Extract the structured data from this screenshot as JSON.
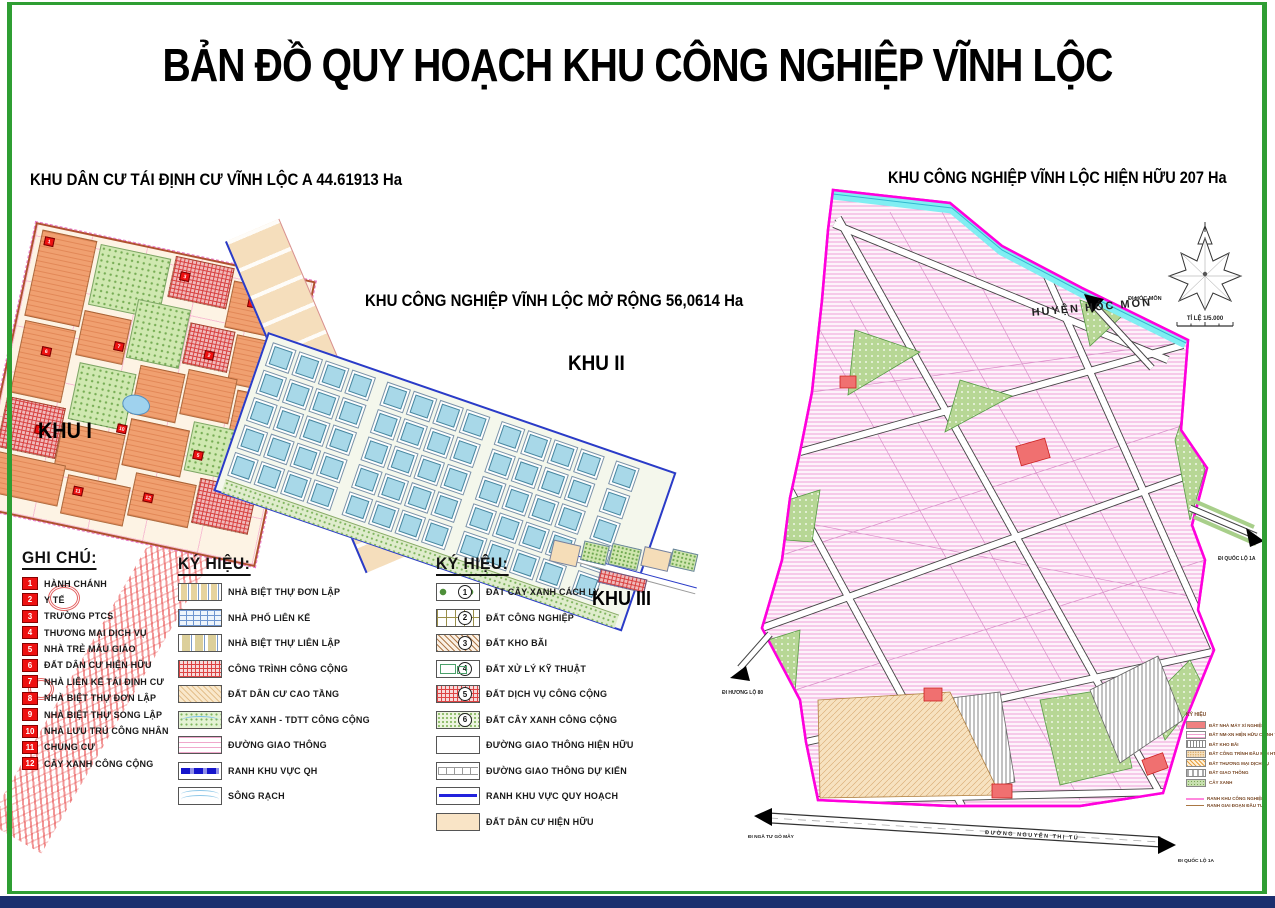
{
  "title": "BẢN ĐỒ QUY HOẠCH KHU CÔNG NGHIỆP VĨNH LỘC",
  "headers": {
    "residential": "KHU DÂN CƯ TÁI ĐỊNH CƯ VĨNH LỘC A 44.61913 Ha",
    "expansion": "KHU CÔNG NGHIỆP VĨNH LỘC MỞ RỘNG 56,0614 Ha",
    "existing": "KHU CÔNG NGHIỆP VĨNH LỘC HIỆN HỮU 207 Ha"
  },
  "zones": {
    "zone1": "KHU I",
    "zone2": "KHU II",
    "zone3": "KHU III"
  },
  "map_labels": {
    "district": "HUYỆN HÓC MÔN",
    "scale": "TỈ LỆ 1/5.000",
    "bottom_road": "ĐƯỜNG NGUYỄN THỊ TÚ",
    "arrow_nw": "ĐI HÓC MÔN",
    "arrow_right": "ĐI QUỐC LỘ 1A",
    "arrow_sw": "ĐI HƯƠNG LỘ 80",
    "arrow_bottom_left": "ĐI NGÃ TƯ GÒ MÂY",
    "arrow_bottom_right": "ĐI QUỐC LỘ 1A"
  },
  "legend_notes": {
    "title": "GHI CHÚ:",
    "items": [
      {
        "num": "1",
        "label": "HÀNH CHÁNH"
      },
      {
        "num": "2",
        "label": "Y TẾ"
      },
      {
        "num": "3",
        "label": "TRƯỜNG PTCS"
      },
      {
        "num": "4",
        "label": "THƯƠNG MẠI DỊCH VỤ"
      },
      {
        "num": "5",
        "label": "NHÀ TRẺ MẪU GIÁO"
      },
      {
        "num": "6",
        "label": "ĐẤT DÂN CƯ HIỆN HỮU"
      },
      {
        "num": "7",
        "label": "NHÀ LIÊN KẾ TÁI ĐỊNH CƯ"
      },
      {
        "num": "8",
        "label": "NHÀ BIỆT THỰ ĐƠN LẬP"
      },
      {
        "num": "9",
        "label": "NHÀ BIỆT THỰ SONG LẬP"
      },
      {
        "num": "10",
        "label": "NHÀ LƯU TRÚ CÔNG NHÂN"
      },
      {
        "num": "11",
        "label": "CHUNG CƯ"
      },
      {
        "num": "12",
        "label": "CÂY XANH CÔNG CỘNG"
      }
    ]
  },
  "legend_symbols1": {
    "title": "KÝ HIỆU:",
    "items": [
      {
        "label": "NHÀ BIỆT THỰ ĐƠN LẬP",
        "swatch": "sw-villa"
      },
      {
        "label": "NHÀ PHỐ LIÊN KẾ",
        "swatch": "sw-rowhouse"
      },
      {
        "label": "NHÀ BIỆT THỰ LIÊN LẬP",
        "swatch": "sw-duplex"
      },
      {
        "label": "CÔNG TRÌNH CÔNG CỘNG",
        "swatch": "sw-public"
      },
      {
        "label": "ĐẤT DÂN CƯ CAO TẦNG",
        "swatch": "sw-hirise"
      },
      {
        "label": "CÂY XANH - TDTT CÔNG CỘNG",
        "swatch": "sw-greentdtt"
      },
      {
        "label": "ĐƯỜNG GIAO THÔNG",
        "swatch": "sw-road"
      },
      {
        "label": "RANH KHU VỰC QH",
        "swatch": "sw-ranh"
      },
      {
        "label": "SÔNG RẠCH",
        "swatch": "sw-river"
      }
    ]
  },
  "legend_symbols2": {
    "title": "KÝ HIỆU:",
    "items": [
      {
        "num": "1",
        "label": "ĐẤT CÂY XANH CÁCH LY",
        "swatch": "sw-isogreen"
      },
      {
        "num": "2",
        "label": "ĐẤT CÔNG NGHIỆP",
        "swatch": "sw-industry"
      },
      {
        "num": "3",
        "label": "ĐẤT KHO BÃI",
        "swatch": "sw-khobai"
      },
      {
        "num": "4",
        "label": "ĐẤT XỬ LÝ KỸ THUẬT",
        "swatch": "sw-kythuat"
      },
      {
        "num": "5",
        "label": "ĐẤT DỊCH VỤ CÔNG CỘNG",
        "swatch": "sw-dichvu"
      },
      {
        "num": "6",
        "label": "ĐẤT CÂY XANH CÔNG CỘNG",
        "swatch": "sw-greenpark"
      },
      {
        "label": "ĐƯỜNG GIAO THÔNG HIỆN HỮU",
        "swatch": "sw-roadexist"
      },
      {
        "label": "ĐƯỜNG GIAO THÔNG DỰ KIẾN",
        "swatch": "sw-roadplan"
      },
      {
        "label": "RANH KHU VỰC QUY HOẠCH",
        "swatch": "sw-ranh2"
      },
      {
        "label": "ĐẤT DÂN CƯ HIỆN HỮU",
        "swatch": "sw-dancu"
      }
    ]
  },
  "mini_legend": {
    "title": "KÝ HIỆU",
    "items": [
      {
        "label": "ĐẤT NHÀ MÁY XÍ NGHIỆP",
        "swatch": "m1"
      },
      {
        "label": "ĐẤT NM-XN HIỆN HỮU CHỈNH TRANG",
        "swatch": "m2"
      },
      {
        "label": "ĐẤT KHO BÃI",
        "swatch": "m3"
      },
      {
        "label": "ĐẤT CÔNG TRÌNH ĐẦU MỐI HT",
        "swatch": "m4"
      },
      {
        "label": "ĐẤT THƯƠNG MẠI DỊCH VỤ",
        "swatch": "m5"
      },
      {
        "label": "ĐẤT GIAO THÔNG",
        "swatch": "m6"
      },
      {
        "label": "CÂY XANH",
        "swatch": "m7"
      }
    ],
    "lines": [
      {
        "label": "RANH KHU CÔNG NGHIỆP",
        "swatch": "mline1"
      },
      {
        "label": "RANH GIAI ĐOẠN ĐẦU TƯ",
        "swatch": "mline2"
      }
    ]
  },
  "colors": {
    "boundary_magenta": "#FF00DD",
    "ranh_blue": "#2A3BC8",
    "note_red": "#EE1111",
    "frame_green": "#2F9E33",
    "bottom_navy": "#1B2F6E",
    "river_cyan": "#80EEF2",
    "lot_pink": "#F0A0D8"
  }
}
